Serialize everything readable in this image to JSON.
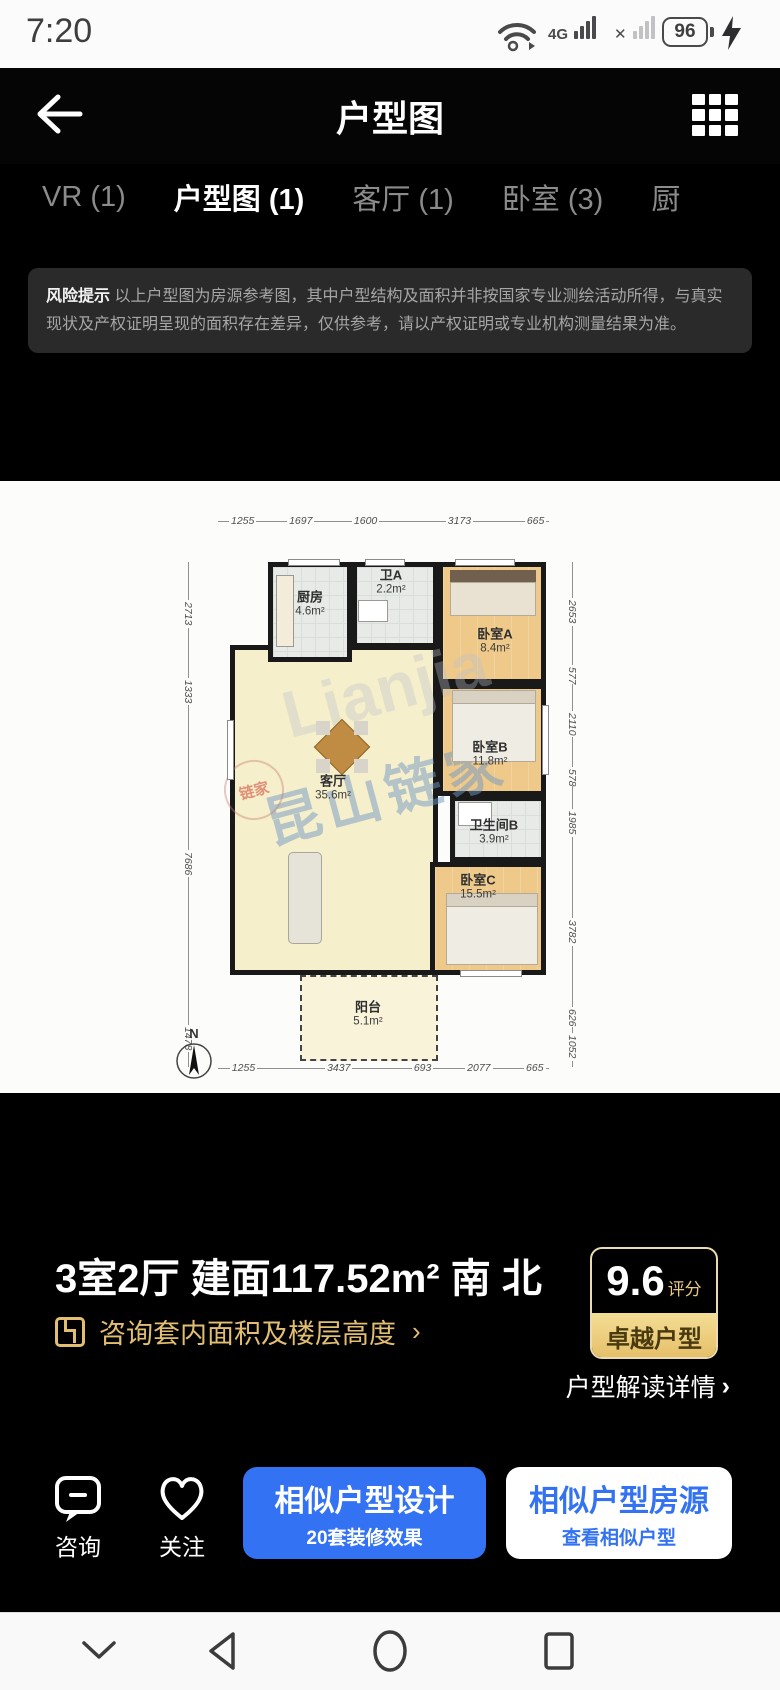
{
  "status_bar": {
    "time": "7:20",
    "network": "4G",
    "battery": "96"
  },
  "header": {
    "title": "户型图"
  },
  "tabs": [
    {
      "label": "VR (1)"
    },
    {
      "label": "户型图 (1)"
    },
    {
      "label": "客厅 (1)"
    },
    {
      "label": "卧室 (3)"
    },
    {
      "label": "厨"
    }
  ],
  "risk_notice": {
    "label": "风险提示",
    "text": "以上户型图为房源参考图，其中户型结构及面积并非按国家专业测绘活动所得，与真实现状及产权证明呈现的面积存在差异，仅供参考，请以产权证明或专业机构测量结果为准。"
  },
  "floor_plan": {
    "rooms": [
      {
        "name": "厨房",
        "area": "4.6m²"
      },
      {
        "name": "卫A",
        "area": "2.2m²"
      },
      {
        "name": "卧室A",
        "area": "8.4m²"
      },
      {
        "name": "卧室B",
        "area": "11.8m²"
      },
      {
        "name": "客厅",
        "area": "35.6m²"
      },
      {
        "name": "卫生间B",
        "area": "3.9m²"
      },
      {
        "name": "卧室C",
        "area": "15.5m²"
      },
      {
        "name": "阳台",
        "area": "5.1m²"
      }
    ],
    "dims_top": [
      "1255",
      "1697",
      "1600",
      "3173",
      "665"
    ],
    "dims_bottom": [
      "1255",
      "3437",
      "693",
      "2077",
      "665"
    ],
    "dims_left": [
      "2713",
      "1333",
      "7686",
      "1478"
    ],
    "dims_right": [
      "2653",
      "577",
      "2110",
      "578",
      "1985",
      "3782",
      "626",
      "1052"
    ],
    "compass": "N",
    "watermark": "昆山链家",
    "watermark_latin": "Lianjia",
    "stamp": "链家"
  },
  "summary": {
    "title": "3室2厅 建面117.52m² 南 北",
    "score": "9.6",
    "score_label": "评分",
    "badge": "卓越户型",
    "consult_link": "咨询套内面积及楼层高度",
    "detail_link": "户型解读详情"
  },
  "actions": {
    "consult": "咨询",
    "follow": "关注",
    "design_title": "相似户型设计",
    "design_subtitle": "20套装修效果",
    "listing_title": "相似户型房源",
    "listing_subtitle": "查看相似户型"
  }
}
